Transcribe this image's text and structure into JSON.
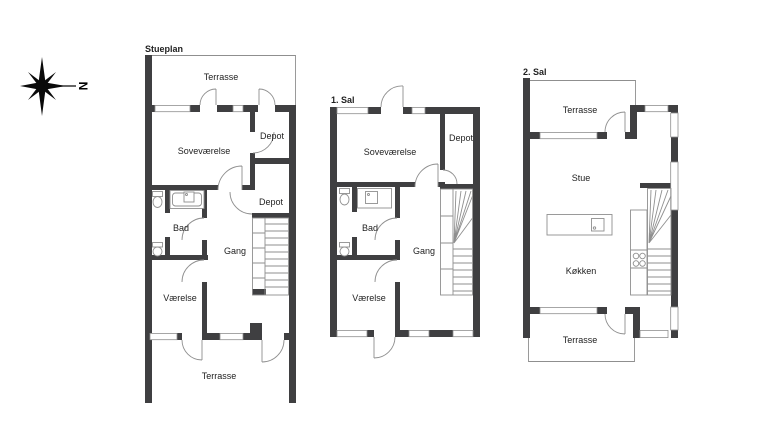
{
  "document": {
    "type": "floor-plan-drawing"
  },
  "compass": {
    "north_label": "N"
  },
  "colors": {
    "wall": "#3f3f41",
    "line": "#8f8f8f",
    "text": "#1f1f1f",
    "background": "#ffffff"
  },
  "plans": {
    "stueplan": {
      "title": "Stueplan",
      "rooms": {
        "terrace_top": "Terrasse",
        "bedroom": "Soveværelse",
        "depot_upper": "Depot",
        "depot_lower": "Depot",
        "bath": "Bad",
        "hallway": "Gang",
        "room": "Værelse",
        "terrace_bottom": "Terrasse"
      }
    },
    "first_floor": {
      "title": "1. Sal",
      "rooms": {
        "bedroom": "Soveværelse",
        "depot": "Depot",
        "bath": "Bad",
        "hallway": "Gang",
        "room": "Værelse"
      }
    },
    "second_floor": {
      "title": "2. Sal",
      "rooms": {
        "terrace_top": "Terrasse",
        "living_room": "Stue",
        "kitchen": "Køkken",
        "terrace_bottom": "Terrasse"
      }
    }
  }
}
